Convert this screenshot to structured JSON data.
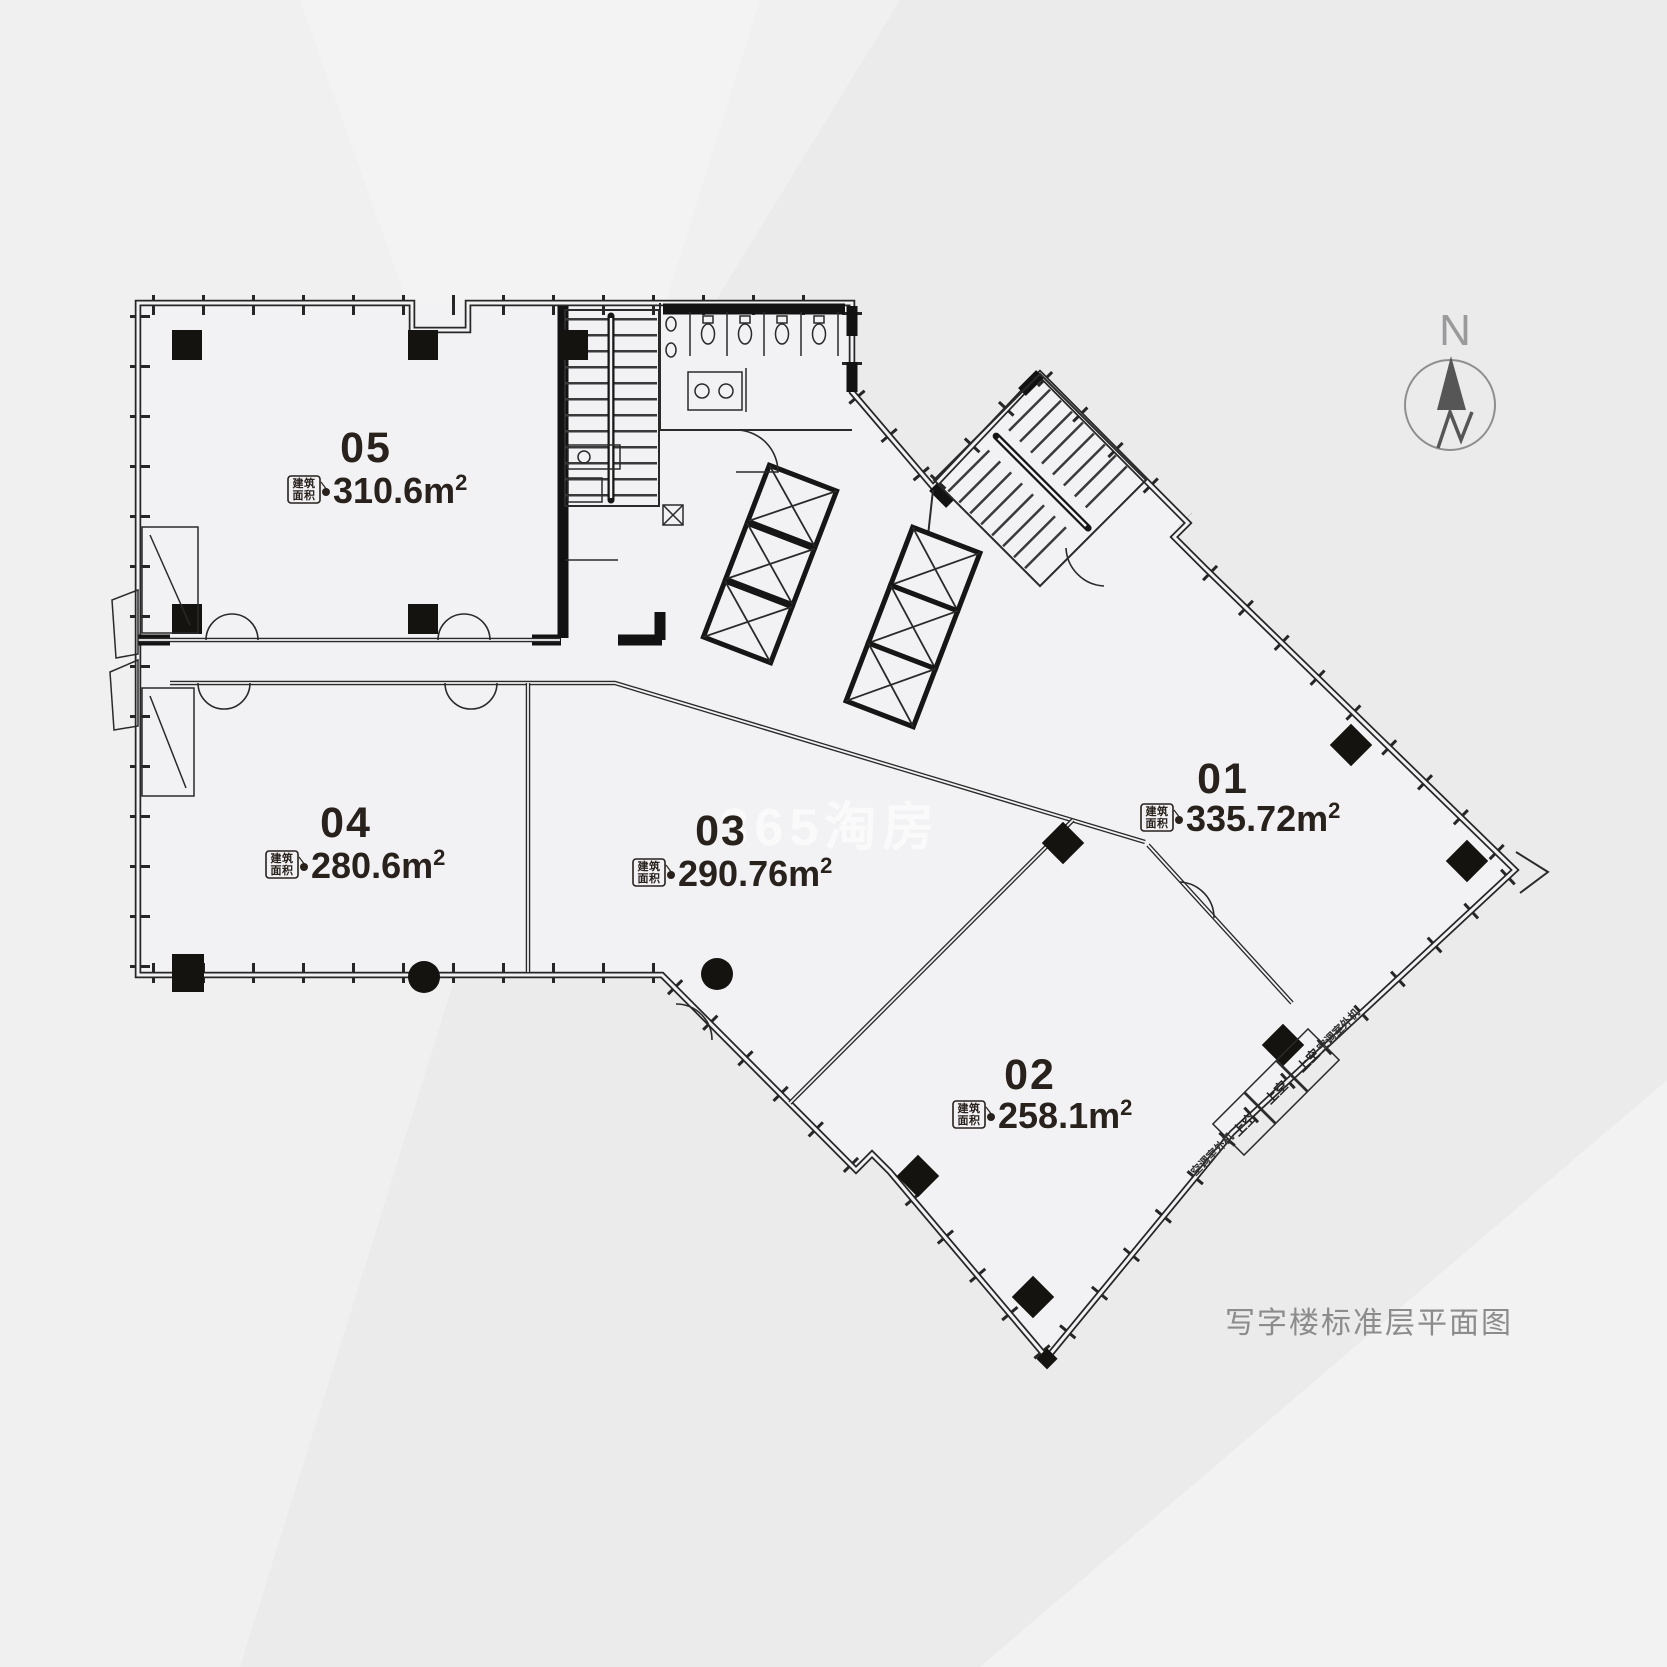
{
  "page": {
    "caption": "写字楼标准层平面图",
    "watermark": "365淘房"
  },
  "compass": {
    "label": "N"
  },
  "area_box": {
    "line1": "建筑",
    "line2": "面积"
  },
  "units": [
    {
      "number": "01",
      "area_value": "335.72",
      "unit": "m",
      "sup": "2"
    },
    {
      "number": "02",
      "area_value": "258.1",
      "unit": "m",
      "sup": "2"
    },
    {
      "number": "03",
      "area_value": "290.76",
      "unit": "m",
      "sup": "2"
    },
    {
      "number": "04",
      "area_value": "280.6",
      "unit": "m",
      "sup": "2"
    },
    {
      "number": "05",
      "area_value": "310.6",
      "unit": "m",
      "sup": "2"
    }
  ],
  "annotations": {
    "void_label": "上空",
    "ac_label": "空调室外机"
  }
}
